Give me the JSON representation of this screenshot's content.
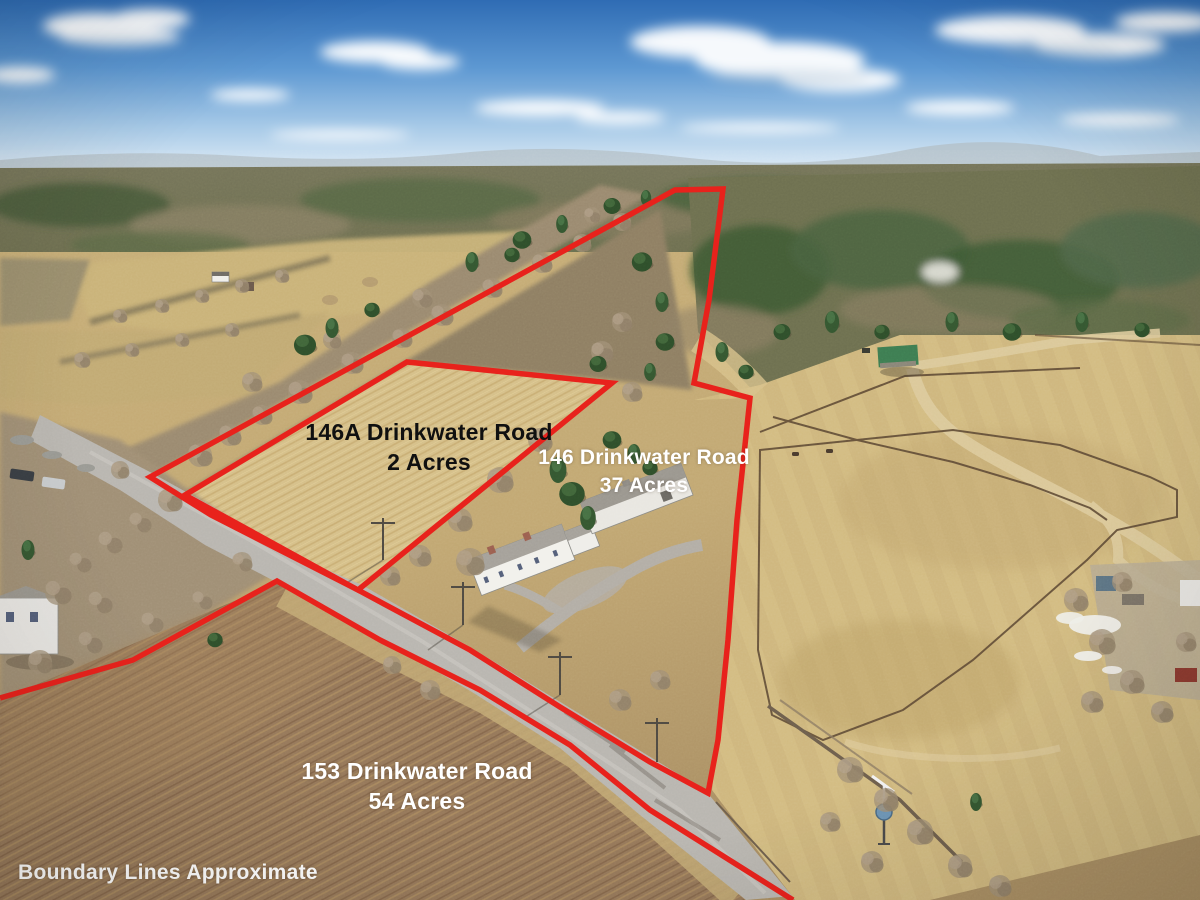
{
  "photo": {
    "description": "Aerial drone photo of rural properties with approximate boundary lines drawn in red",
    "parcels": [
      {
        "address": "146A Drinkwater Road",
        "acres": "2 Acres"
      },
      {
        "address": "146 Drinkwater Road",
        "acres": "37 Acres"
      },
      {
        "address": "153 Drinkwater Road",
        "acres": "54 Acres"
      }
    ],
    "disclaimer": "Boundary Lines Approximate"
  },
  "colors": {
    "boundary_line": "#e8221c",
    "label_dark": "#101010",
    "label_light": "#ffffff",
    "sky_top": "#2f6cb4",
    "sky_horizon": "#e6f0f8",
    "field_tan": "#cdb67e",
    "meadow_tan": "#d6c089",
    "plowed_brown": "#96785a",
    "conifer_green": "#33512e",
    "bare_tree_brown": "#a29077",
    "road_gray": "#b9b6b0"
  }
}
